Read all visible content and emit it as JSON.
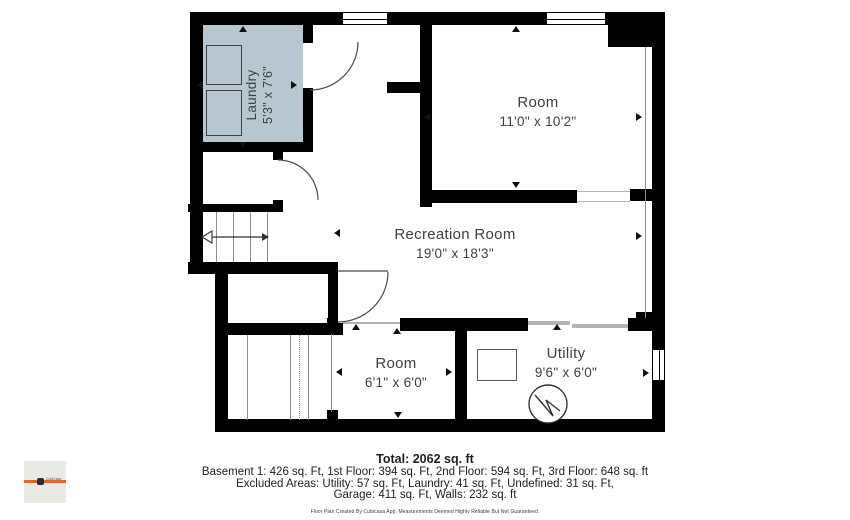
{
  "title": "Basement floor plan",
  "colors": {
    "laundry_fill": "#b8c6cf",
    "accent_orange": "#e0662f",
    "wall": "#000000",
    "text": "#3c4144"
  },
  "rooms": [
    {
      "id": "laundry",
      "name": "Laundry",
      "dims": "5'3\" x 7'6\""
    },
    {
      "id": "room-top",
      "name": "Room",
      "dims": "11'0\" x 10'2\""
    },
    {
      "id": "recreation",
      "name": "Recreation Room",
      "dims": "19'0\" x 18'3\""
    },
    {
      "id": "room-bottom",
      "name": "Room",
      "dims": "6'1\" x 6'0\""
    },
    {
      "id": "utility",
      "name": "Utility",
      "dims": "9'6\" x 6'0\""
    }
  ],
  "summary": {
    "total": "Total: 2062 sq. ft",
    "floors": "Basement 1: 426 sq. Ft, 1st Floor: 394 sq. Ft, 2nd Floor: 594 sq. Ft, 3rd Floor: 648 sq. ft",
    "excluded1": "Excluded Areas: Utility: 57 sq. Ft, Laundry: 41 sq. Ft, Undefined: 31 sq. Ft,",
    "excluded2": "Garage: 411 sq. Ft, Walls: 232 sq. ft",
    "disclaimer": "Floor Plan Created By Cubicasa App. Measurements Deemed Highly Reliable But Not Guaranteed."
  },
  "logo": {
    "brand": "CubiCasa"
  }
}
